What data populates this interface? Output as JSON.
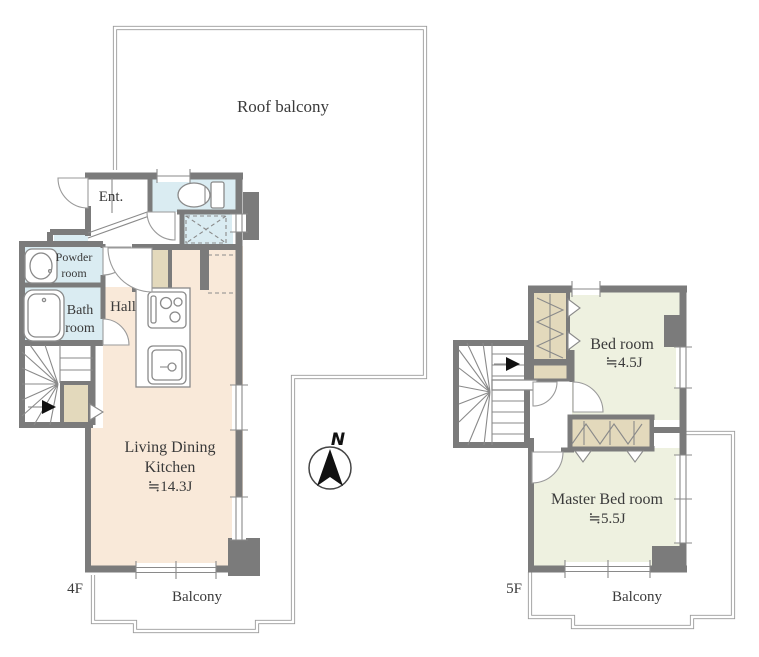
{
  "page": {
    "background": "#ffffff",
    "type": "floor-plan"
  },
  "colors": {
    "wall": "#7b7b7b",
    "ldk_floor": "#f9e9d9",
    "bedroom_floor": "#eef1e0",
    "wet_area_floor": "#daecf2",
    "closet": "#e3d9bc",
    "balcony_outline": "#9b9b9b",
    "text": "#3a3a3a",
    "compass_needle": "#111111"
  },
  "plan4f": {
    "floor_label": "4F",
    "roof_balcony_label": "Roof balcony",
    "balcony_label": "Balcony",
    "entrance_label": "Ent.",
    "powder_room_line1": "Powder",
    "powder_room_line2": "room",
    "bath_room_line1": "Bath",
    "bath_room_line2": "room",
    "hall_label": "Hall",
    "ldk_line1": "Living Dining",
    "ldk_line2": "Kitchen",
    "ldk_area": "≒14.3J"
  },
  "plan5f": {
    "floor_label": "5F",
    "balcony_label": "Balcony",
    "bedroom_label": "Bed room",
    "bedroom_area": "≒4.5J",
    "master_bedroom_label": "Master Bed room",
    "master_bedroom_area": "≒5.5J"
  },
  "compass": {
    "north_label": "N"
  }
}
